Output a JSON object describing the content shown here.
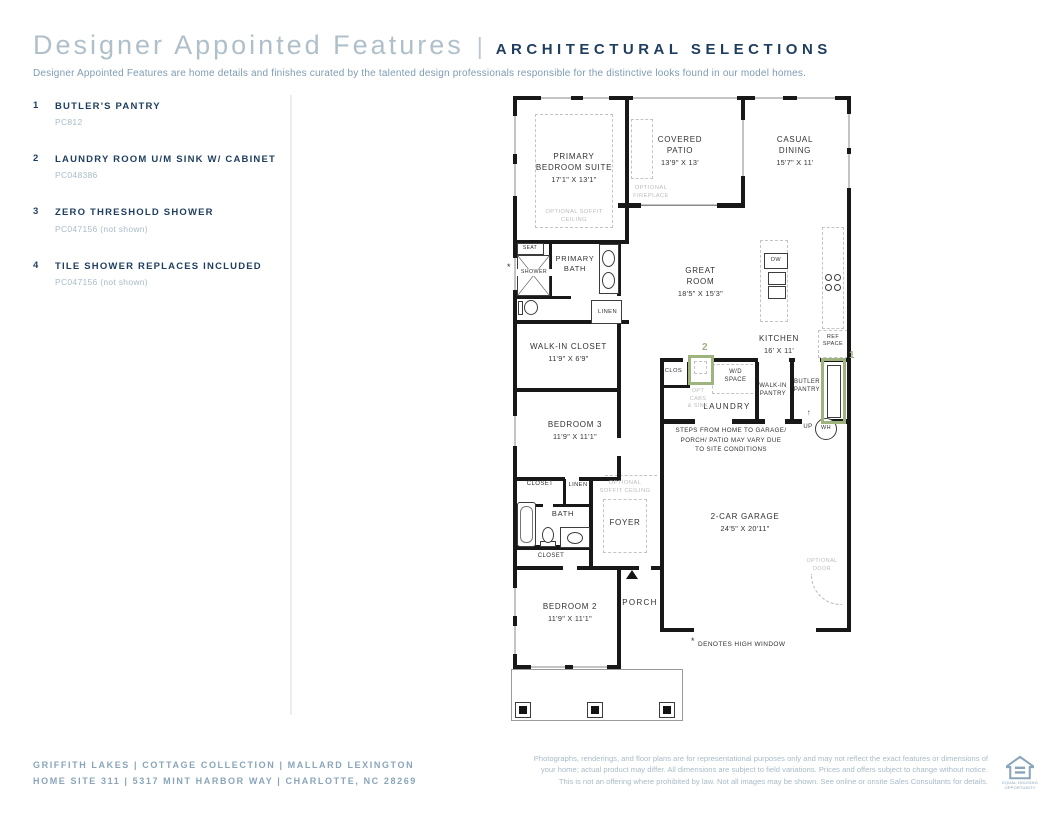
{
  "header": {
    "title": "Designer Appointed Features",
    "divider": "|",
    "section": "ARCHITECTURAL SELECTIONS",
    "description": "Designer Appointed Features are home details and finishes curated by the talented design professionals responsible for the distinctive looks found in our model homes."
  },
  "features": [
    {
      "num": "1",
      "title": "BUTLER'S PANTRY",
      "code": "PC812"
    },
    {
      "num": "2",
      "title": "LAUNDRY ROOM U/M SINK W/ CABINET",
      "code": "PC048386"
    },
    {
      "num": "3",
      "title": "ZERO THRESHOLD SHOWER",
      "code": "PC047156 (not shown)"
    },
    {
      "num": "4",
      "title": "TILE SHOWER REPLACES INCLUDED",
      "code": "PC047156 (not shown)"
    }
  ],
  "floorplan": {
    "rooms": {
      "primary_bedroom": {
        "name": "PRIMARY\nBEDROOM SUITE",
        "dims": "17'1\" X 13'1\""
      },
      "covered_patio": {
        "name": "COVERED\nPATIO",
        "dims": "13'9\" X  13'"
      },
      "casual_dining": {
        "name": "CASUAL\nDINING",
        "dims": "15'7\" X 11'"
      },
      "great_room": {
        "name": "GREAT\nROOM",
        "dims": "18'5\" X 15'3\""
      },
      "kitchen": {
        "name": "KITCHEN",
        "dims": "16' X 11'"
      },
      "primary_bath": {
        "name": "PRIMARY\nBATH"
      },
      "walk_in_closet": {
        "name": "WALK-IN CLOSET",
        "dims": "11'9\" X 6'9\""
      },
      "bedroom_3": {
        "name": "BEDROOM 3",
        "dims": "11'9\" X 11'1\""
      },
      "bath": {
        "name": "BATH"
      },
      "foyer": {
        "name": "FOYER"
      },
      "bedroom_2": {
        "name": "BEDROOM 2",
        "dims": "11'9\" X 11'1\""
      },
      "porch": {
        "name": "PORCH"
      },
      "garage": {
        "name": "2-CAR GARAGE",
        "dims": "24'5\" X 20'11\""
      },
      "laundry": {
        "name": "LAUNDRY"
      },
      "walk_in_pantry": {
        "name": "WALK-IN\nPANTRY"
      },
      "butler_pantry": {
        "name": "BUTLER\nPANTRY"
      }
    },
    "labels": {
      "seat": "SEAT",
      "shower": "SHOWER",
      "linen": "LINEN",
      "clos": "CLOS",
      "closet": "CLOSET",
      "wd_space": "W/D\nSPACE",
      "ref_space": "REF\nSPACE",
      "dw": "DW",
      "up": "UP",
      "up_arrow": "↑",
      "wh": "WH",
      "opt_cabs_sink": "OPT\nCABS\n& SINK",
      "optional_fireplace": "OPTIONAL\nFIREPLACE",
      "optional_soffit": "OPTIONAL SOFFIT\nCEILING",
      "optional_soffit2": "OPTIONAL\nSOFFIT CEILING",
      "optional_door": "OPTIONAL\nDOOR",
      "steps_note": "STEPS FROM HOME TO GARAGE/\nPORCH/ PATIO MAY VARY DUE\nTO SITE CONDITIONS",
      "star": "*",
      "high_window_note": "DENOTES HIGH WINDOW"
    },
    "callouts": {
      "one": "1",
      "two": "2"
    }
  },
  "footer": {
    "left_line1": "GRIFFITH LAKES | COTTAGE COLLECTION | MALLARD LEXINGTON",
    "left_line2": "HOME SITE 311 | 5317 MINT HARBOR WAY | CHARLOTTE, NC 28269",
    "disclaimer": "Photographs, renderings, and floor plans are for representational purposes only and may not reflect the exact features or dimensions of your home; actual product may differ. All dimensions are subject to field variations. Prices and offers subject to change without notice. This is not an offering where prohibited by law. Not all images may be shown. See online or onsite Sales Consultants for details.",
    "equal_housing": "EQUAL HOUSING OPPORTUNITY"
  }
}
